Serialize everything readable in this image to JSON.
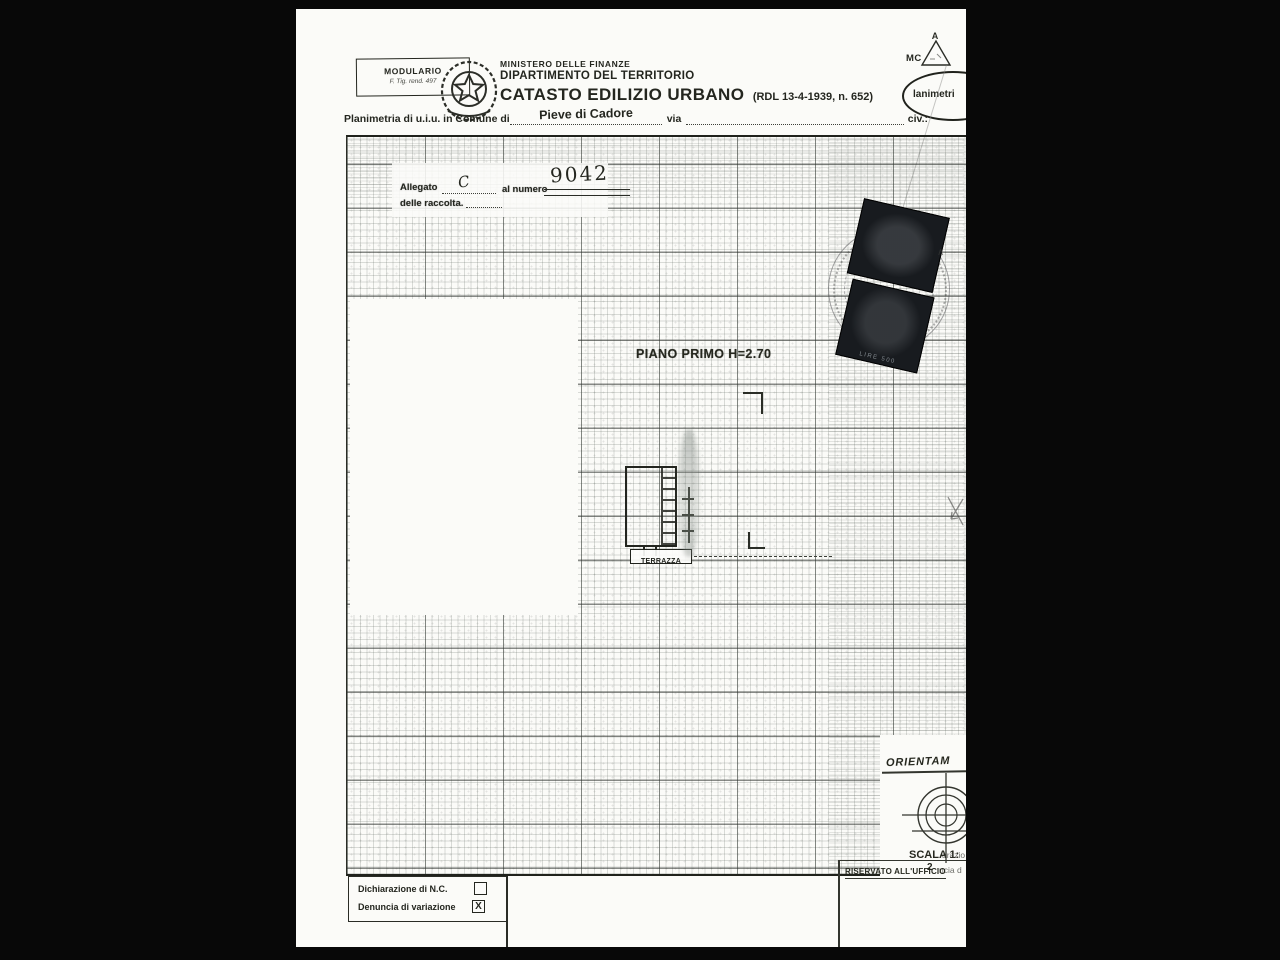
{
  "scan": {
    "modulario": {
      "line1": "MODULARIO",
      "line2": "F. Tig. rend. 497"
    },
    "header": {
      "ministry": "MINISTERO DELLE FINANZE",
      "department": "DIPARTIMENTO DEL TERRITORIO",
      "title": "CATASTO EDILIZIO URBANO",
      "title_ref": "(RDL 13-4-1939, n. 652)"
    },
    "form_line": {
      "prefix": "Planimetria di u.i.u. in Comune di",
      "comune": "Pieve di Cadore",
      "via": "via",
      "civ": "civ.:"
    },
    "top_right": {
      "mc": "MC",
      "triangle_letter": "A",
      "oval_text": "lanimetri"
    },
    "allegato": {
      "label": "Allegato",
      "letter": "C",
      "al_numero": "al numero",
      "number": "9042",
      "raccolta": "delle raccolta."
    },
    "plan": {
      "floor_label": "PIANO PRIMO H=2.70",
      "terrace_label": "TERRAZZA"
    },
    "stamp": {
      "value": "LIRE 500"
    },
    "orientation": {
      "label": "ORIENTAM",
      "scala": "SCALA 1:",
      "scala_denom": "2",
      "fragment_top": "arazio",
      "fragment_bottom": "ncia d",
      "reserved": "RISERVATO ALL'UFFICIO"
    },
    "footer": {
      "row1": "Dichiarazione di N.C.",
      "row2": "Denuncia di variazione",
      "check_mark": "X"
    },
    "marks": {
      "caret": "∧"
    },
    "colors": {
      "page": "#fbfbf8",
      "ink": "#24261f",
      "stamp_dark": "#181b1f",
      "background": "#080808"
    }
  }
}
